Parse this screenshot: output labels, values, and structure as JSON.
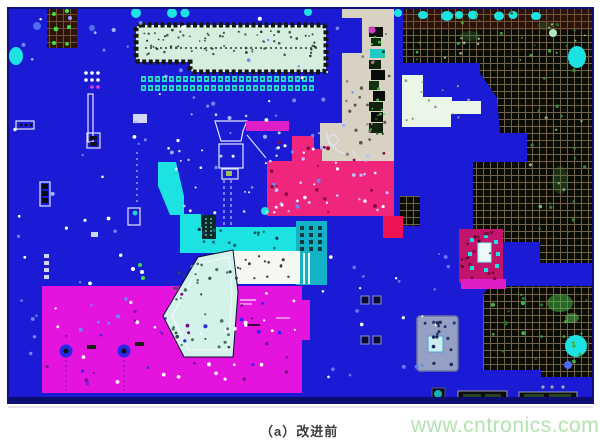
{
  "figure": {
    "caption": "（a）改进前",
    "watermark": "www.cntronics.com",
    "caption_color": "#3d3d3d",
    "watermark_color": "#b2e3ae"
  },
  "colors": {
    "board_blue": "#1b1bd6",
    "board_border": "#10107a",
    "magenta": "#e414de",
    "hot_pink": "#f0257c",
    "crimson": "#c2146a",
    "red_pink": "#ee1453",
    "magenta_bar": "#e01ec8",
    "cyan": "#1de2e2",
    "teal": "#14b2c6",
    "pale_cyan": "#d2f2ea",
    "white_region": "#f5f7f1",
    "cream": "#eaf6e8",
    "beige": "#d8d2c2",
    "connector_fill": "#d6eedd",
    "grid_dark": "#0c0c06",
    "grid_line": "#9a8468",
    "green_fleck": "#3fe03f",
    "light_blue_speck": "#6e88f0"
  }
}
